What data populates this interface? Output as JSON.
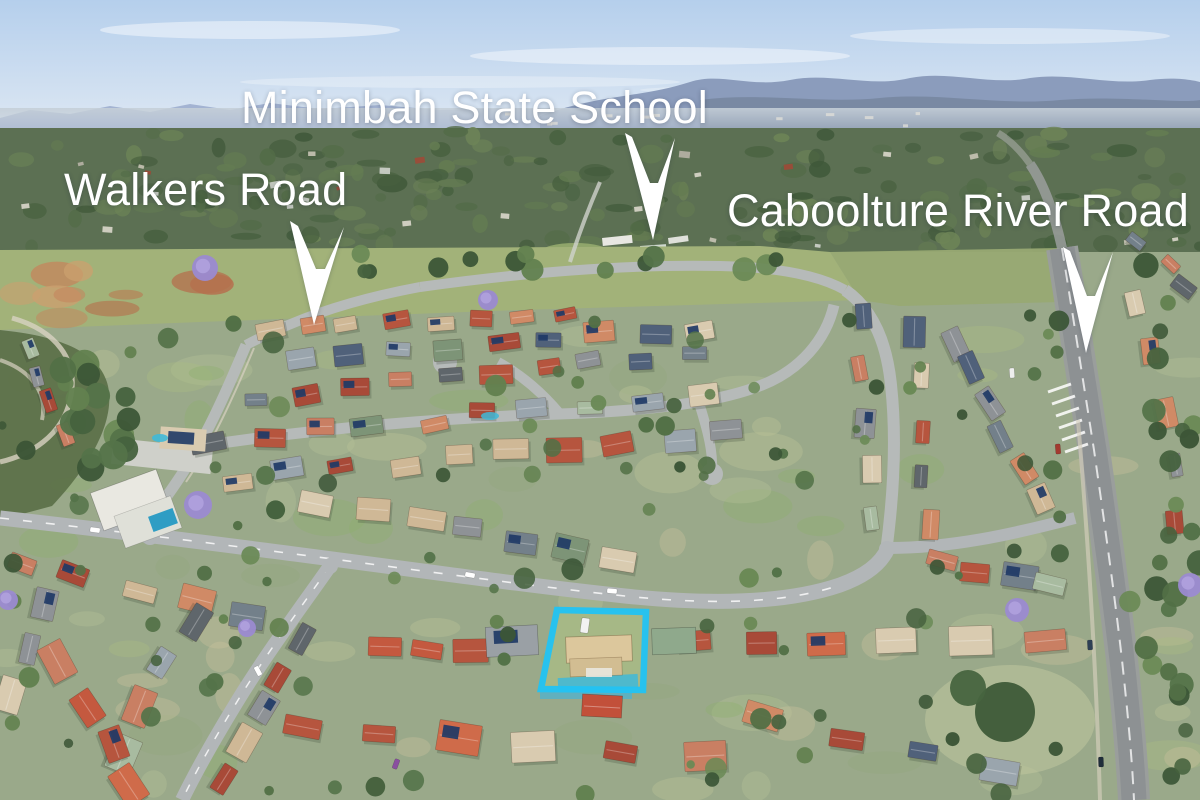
{
  "page": {
    "type": "aerial-property-photo",
    "width": 1200,
    "height": 800
  },
  "annotations": {
    "label_color": "#ffffff",
    "arrow_color": "#ffffff",
    "labels": [
      {
        "id": "minimbah-state-school",
        "text": "Minimbah State School"
      },
      {
        "id": "walkers-road",
        "text": "Walkers Road"
      },
      {
        "id": "caboolture-river-road",
        "text": "Caboolture River Road"
      }
    ],
    "arrows": [
      {
        "target": "minimbah-state-school",
        "points": "625,133 653,240 675,138 658,183 650,183 632,137"
      },
      {
        "target": "walkers-road",
        "points": "290,221 314,325 344,227 325,269 316,269 298,226"
      },
      {
        "target": "caboolture-river-road",
        "points": "1063,247 1086,353 1113,252 1095,296 1087,296 1070,251"
      }
    ],
    "property_highlight": {
      "color": "#22c3f2",
      "points": "557,610 646,612 643,690 541,689"
    }
  },
  "palette": {
    "sky_top": "#b5cfec",
    "sky_horizon": "#e3ebf4",
    "mountain_far": "#a3b3d2",
    "mountain_main": "#8b9cbc",
    "mountain_near": "#75869f",
    "haze": "#c5cfd8",
    "forest": "#5c7053",
    "forest_blobs": [
      "#47603f",
      "#526b47",
      "#3f5839",
      "#647c52",
      "#6d8457"
    ],
    "field": "#a2b279",
    "field_right": "#98a973",
    "dirt_blobs": [
      "#b5714e",
      "#c5845c",
      "#caa06f",
      "#b97a52"
    ],
    "ground": "#9aa98a",
    "lawn_patches": [
      "#8fae6e",
      "#a9bc83",
      "#bcc496",
      "#93a87c",
      "#b4c097",
      "#c8c19a"
    ],
    "road": "#b2b6b8",
    "road_major": "#8d9193",
    "road_shoulder": "#9a9e9c",
    "concrete": "#cfd0ca",
    "path": "#d8d2c2",
    "roofs": [
      "#b6553e",
      "#a84a38",
      "#c97f63",
      "#d08a66",
      "#8e9296",
      "#5f666b",
      "#73808a",
      "#7d9477",
      "#a8bba0",
      "#d9cbb0",
      "#cfb896",
      "#50617a",
      "#9aa5ad"
    ],
    "roofs_warm": [
      "#b6553e",
      "#a84a38",
      "#c4593f",
      "#cf6b4a",
      "#d9cbb0",
      "#c97f63"
    ],
    "distant_roofs": [
      "#dad7cb",
      "#c8c4b5",
      "#b7b3a6",
      "#cfd3cc",
      "#9e4a37"
    ],
    "tree_greens": [
      "#46623e",
      "#547349",
      "#62814f",
      "#3c5637",
      "#6b8a56",
      "#527046"
    ],
    "jacaranda": "#9b8ad1",
    "pool": "#3fb9d8",
    "solar": "#1f3a66",
    "shadow": "#2c3a2c",
    "white": "#ffffff"
  }
}
